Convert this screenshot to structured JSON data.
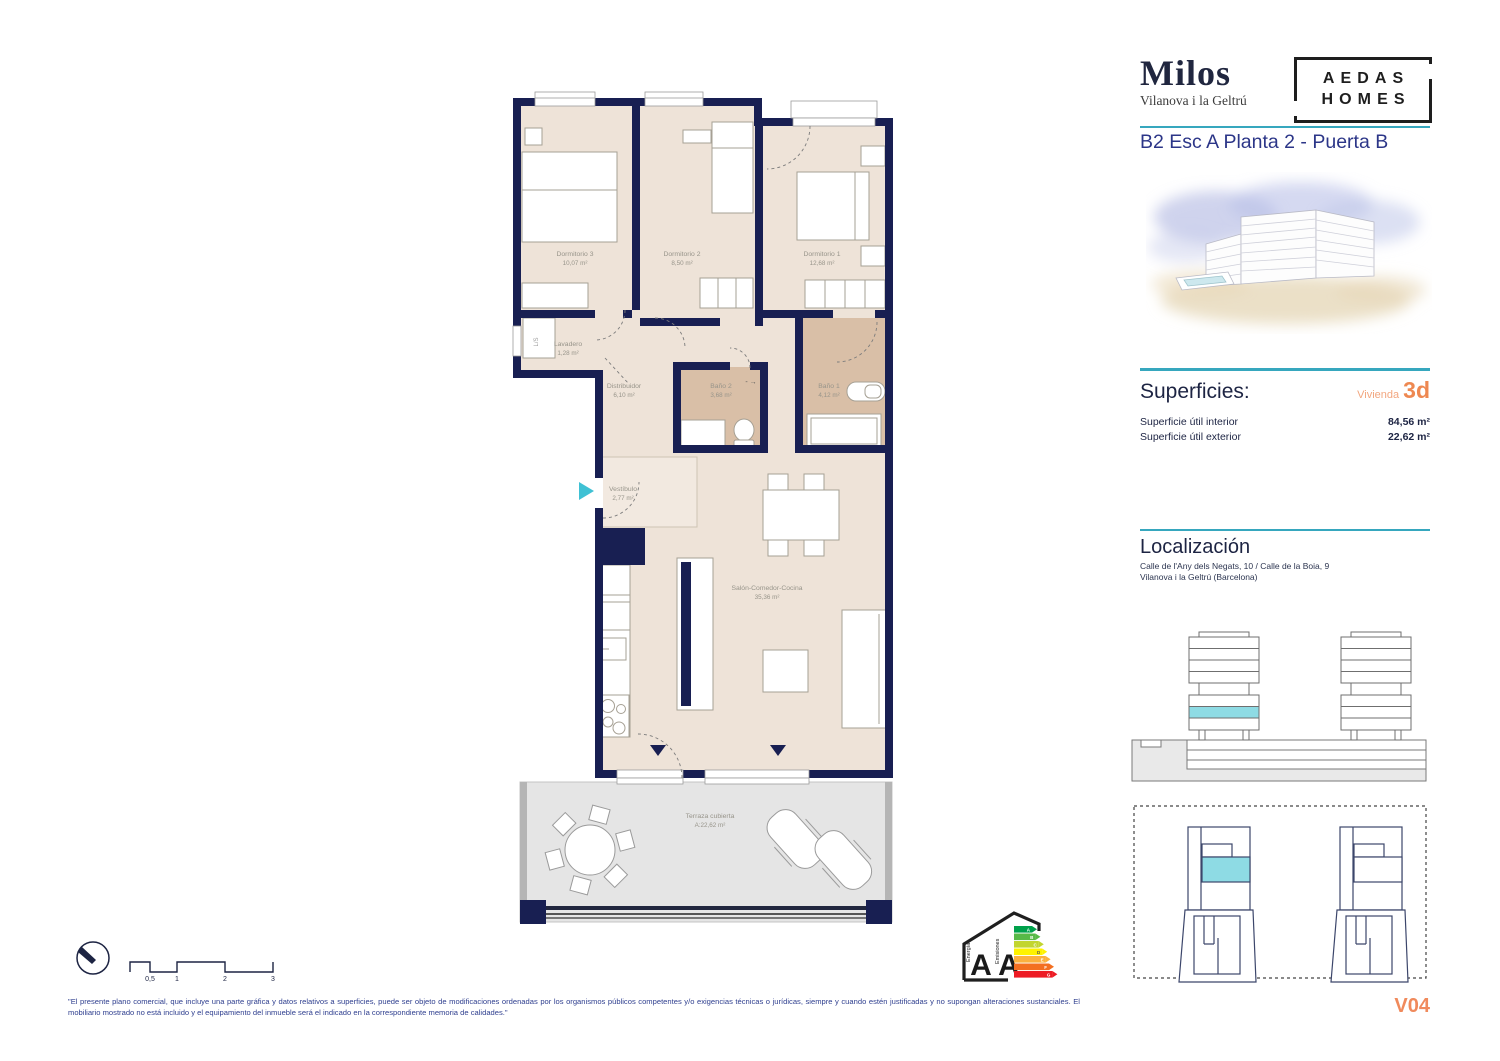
{
  "header": {
    "project_name": "Milos",
    "project_subtitle": "Vilanova i la Geltrú",
    "brand_line1": "AEDAS",
    "brand_line2": "HOMES",
    "plan_title": "B2 Esc A Planta 2 - Puerta B"
  },
  "superficies": {
    "heading": "Superficies:",
    "unit_label": "Vivienda",
    "unit_value": "3d",
    "rows": [
      {
        "label": "Superficie útil interior",
        "value": "84,56 m²"
      },
      {
        "label": "Superficie útil exterior",
        "value": "22,62 m²"
      }
    ]
  },
  "localizacion": {
    "heading": "Localización",
    "address_line1": "Calle de l'Any dels Negats, 10 / Calle de la Boia, 9",
    "address_line2": "Vilanova i la Geltrú (Barcelona)"
  },
  "floorplan": {
    "rooms": [
      {
        "name": "Dormitorio 3",
        "area": "10,07 m²"
      },
      {
        "name": "Dormitorio 2",
        "area": "8,50 m²"
      },
      {
        "name": "Dormitorio 1",
        "area": "12,68 m²"
      },
      {
        "name": "Lavadero",
        "area": "1,28 m²"
      },
      {
        "name": "Distribuidor",
        "area": "6,10 m²"
      },
      {
        "name": "Baño 2",
        "area": "3,68 m²"
      },
      {
        "name": "Baño 1",
        "area": "4,12 m²"
      },
      {
        "name": "Vestíbulo",
        "area": "2,77 m²"
      },
      {
        "name": "Salón-Comedor-Cocina",
        "area": "35,36 m²"
      },
      {
        "name": "Terraza cubierta",
        "area": "A:22,62 m²"
      }
    ],
    "laundry_mark": "L/S",
    "bath2_mark": "- →"
  },
  "energy": {
    "label_energy": "Energía",
    "label_emissions": "Emisiones",
    "rating_energy": "A",
    "rating_emissions": "A",
    "bar_letters": [
      "A",
      "B",
      "C",
      "D",
      "E",
      "F",
      "G"
    ],
    "bar_colors": [
      "#00a14b",
      "#57b947",
      "#c2d52f",
      "#fef200",
      "#fbb03f",
      "#f36f21",
      "#ed1b24"
    ]
  },
  "scale_bar": {
    "ticks": [
      "0,5",
      "1",
      "2",
      "3"
    ]
  },
  "footer": {
    "disclaimer": "\"El presente plano comercial, que incluye una parte gráfica y datos relativos a superficies, puede ser objeto de modificaciones ordenadas por los organismos públicos competentes y/o exigencias técnicas o jurídicas, siempre y cuando estén justificadas y no supongan alteraciones sustanciales. El mobiliario mostrado no está incluido y el equipamiento del inmueble será el indicado en la correspondiente memoria de calidades.\"",
    "version": "V04"
  },
  "colors": {
    "accent_teal": "#36a7be",
    "accent_orange": "#ee8851",
    "navy_text": "#1d2443",
    "wall_navy": "#181f52",
    "highlight_teal": "#8edbe4"
  }
}
